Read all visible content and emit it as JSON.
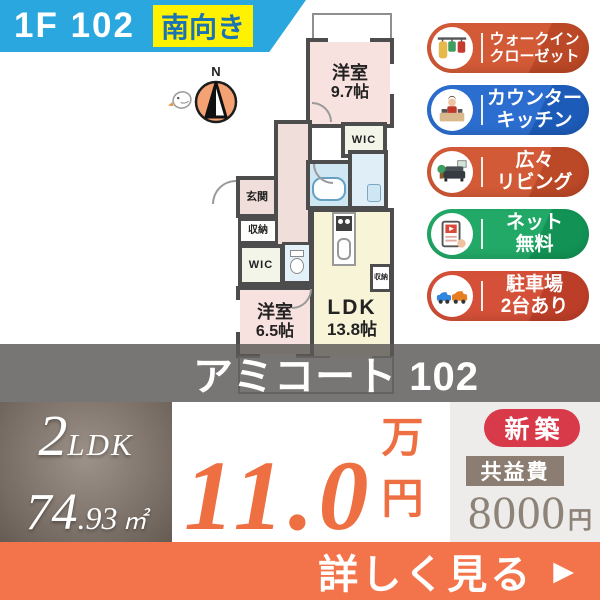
{
  "header": {
    "unit": "1F 102",
    "facing": "南向き"
  },
  "compass": {
    "label": "N"
  },
  "floorplan": {
    "bedroom1": {
      "name": "洋室",
      "size": "9.7帖"
    },
    "wic_top": "WIC",
    "genkan": "玄関",
    "shuno": "収納",
    "wic_left": "WIC",
    "storage_nook": "収納",
    "bedroom2": {
      "name": "洋室",
      "size": "6.5帖"
    },
    "ldk": {
      "name": "LDK",
      "size": "13.8帖"
    }
  },
  "badges": [
    {
      "icon": "walk-in-closet-icon",
      "lines": [
        "ウォークイン",
        "クローゼット"
      ],
      "color": "#d0502a"
    },
    {
      "icon": "counter-kitchen-icon",
      "lines": [
        "カウンター",
        "キッチン"
      ],
      "color": "#1f65cd"
    },
    {
      "icon": "living-icon",
      "lines": [
        "広々",
        "リビング"
      ],
      "color": "#d0502a"
    },
    {
      "icon": "internet-icon",
      "lines": [
        "ネット",
        "無料"
      ],
      "color": "#14a35e"
    },
    {
      "icon": "parking-icon",
      "lines": [
        "駐車場",
        "2台あり"
      ],
      "color": "#d2452c"
    }
  ],
  "building": {
    "name": "アミコート 102"
  },
  "summary": {
    "layout": {
      "num": "2",
      "type": "LDK"
    },
    "area": {
      "int": "74",
      "dec": ".93",
      "unit": "㎡"
    },
    "rent": {
      "value": "11.0",
      "unit": "万円"
    },
    "new_badge": "新築",
    "fee": {
      "label": "共益費",
      "value": "8000",
      "unit": "円"
    }
  },
  "cta": {
    "label": "詳しく見る",
    "arrow": "▶"
  },
  "colors": {
    "banner_blue": "#2ba7e0",
    "facing_yellow": "#fff102",
    "facing_text": "#1b73b4",
    "accent_orange": "#f3734a",
    "price_orange": "#ee6f41",
    "new_badge_red": "#d93a4a",
    "fee_box_taupe": "#8b7d71",
    "wall_gray": "#4d4d4d"
  }
}
